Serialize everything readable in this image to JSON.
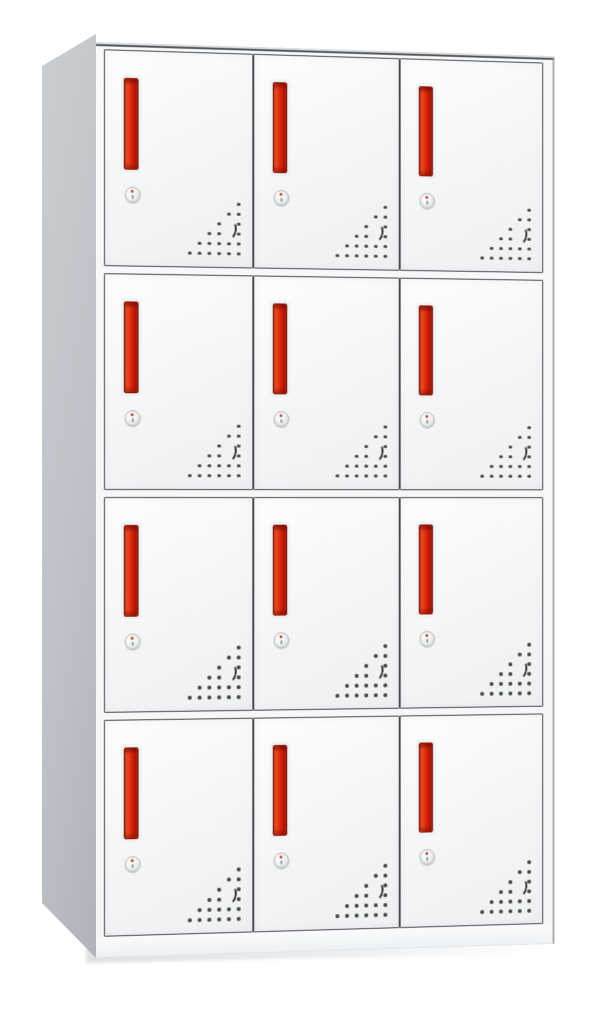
{
  "scene": {
    "description": "Product photograph of a white steel 12-door locker cabinet with red vertical handles, round cam locks and triangular vent perforations on each door, viewed slightly from the left",
    "background_color": "#ffffff"
  },
  "locker": {
    "rows": 4,
    "columns": 3,
    "door_count": 12,
    "door_features": {
      "handle": "vertical-red-bar-handle",
      "lock": "round-cam-lock",
      "vents": "triangular-perforation-pattern"
    },
    "vent_pattern": {
      "rows": 6,
      "cols": 6,
      "step": 10,
      "dot_size": 3.5,
      "shape": "right-aligned-triangle",
      "skip": [
        [
          2,
          4
        ],
        [
          3,
          4
        ]
      ],
      "crescent": {
        "col": 4,
        "row": 2
      }
    },
    "colors": {
      "scene_bg": "#ffffff",
      "cabinet_white": "#f8f9fa",
      "door_face": "#f4f5f6",
      "door_edge": "#46484b",
      "side_panel_light": "#c9ced2",
      "side_panel_dark": "#aeb4ba",
      "handle_red": "#d6220c",
      "handle_red_light": "#ee4a1c",
      "handle_red_dark": "#b01505",
      "handle_border": "#8c1206",
      "lock_silver": "#eceeee",
      "lock_border": "#b4b8ba",
      "lock_red_dot": "#c44027",
      "vent_dot": "#2e3031",
      "floor_shadow": "#dde1e4"
    }
  }
}
